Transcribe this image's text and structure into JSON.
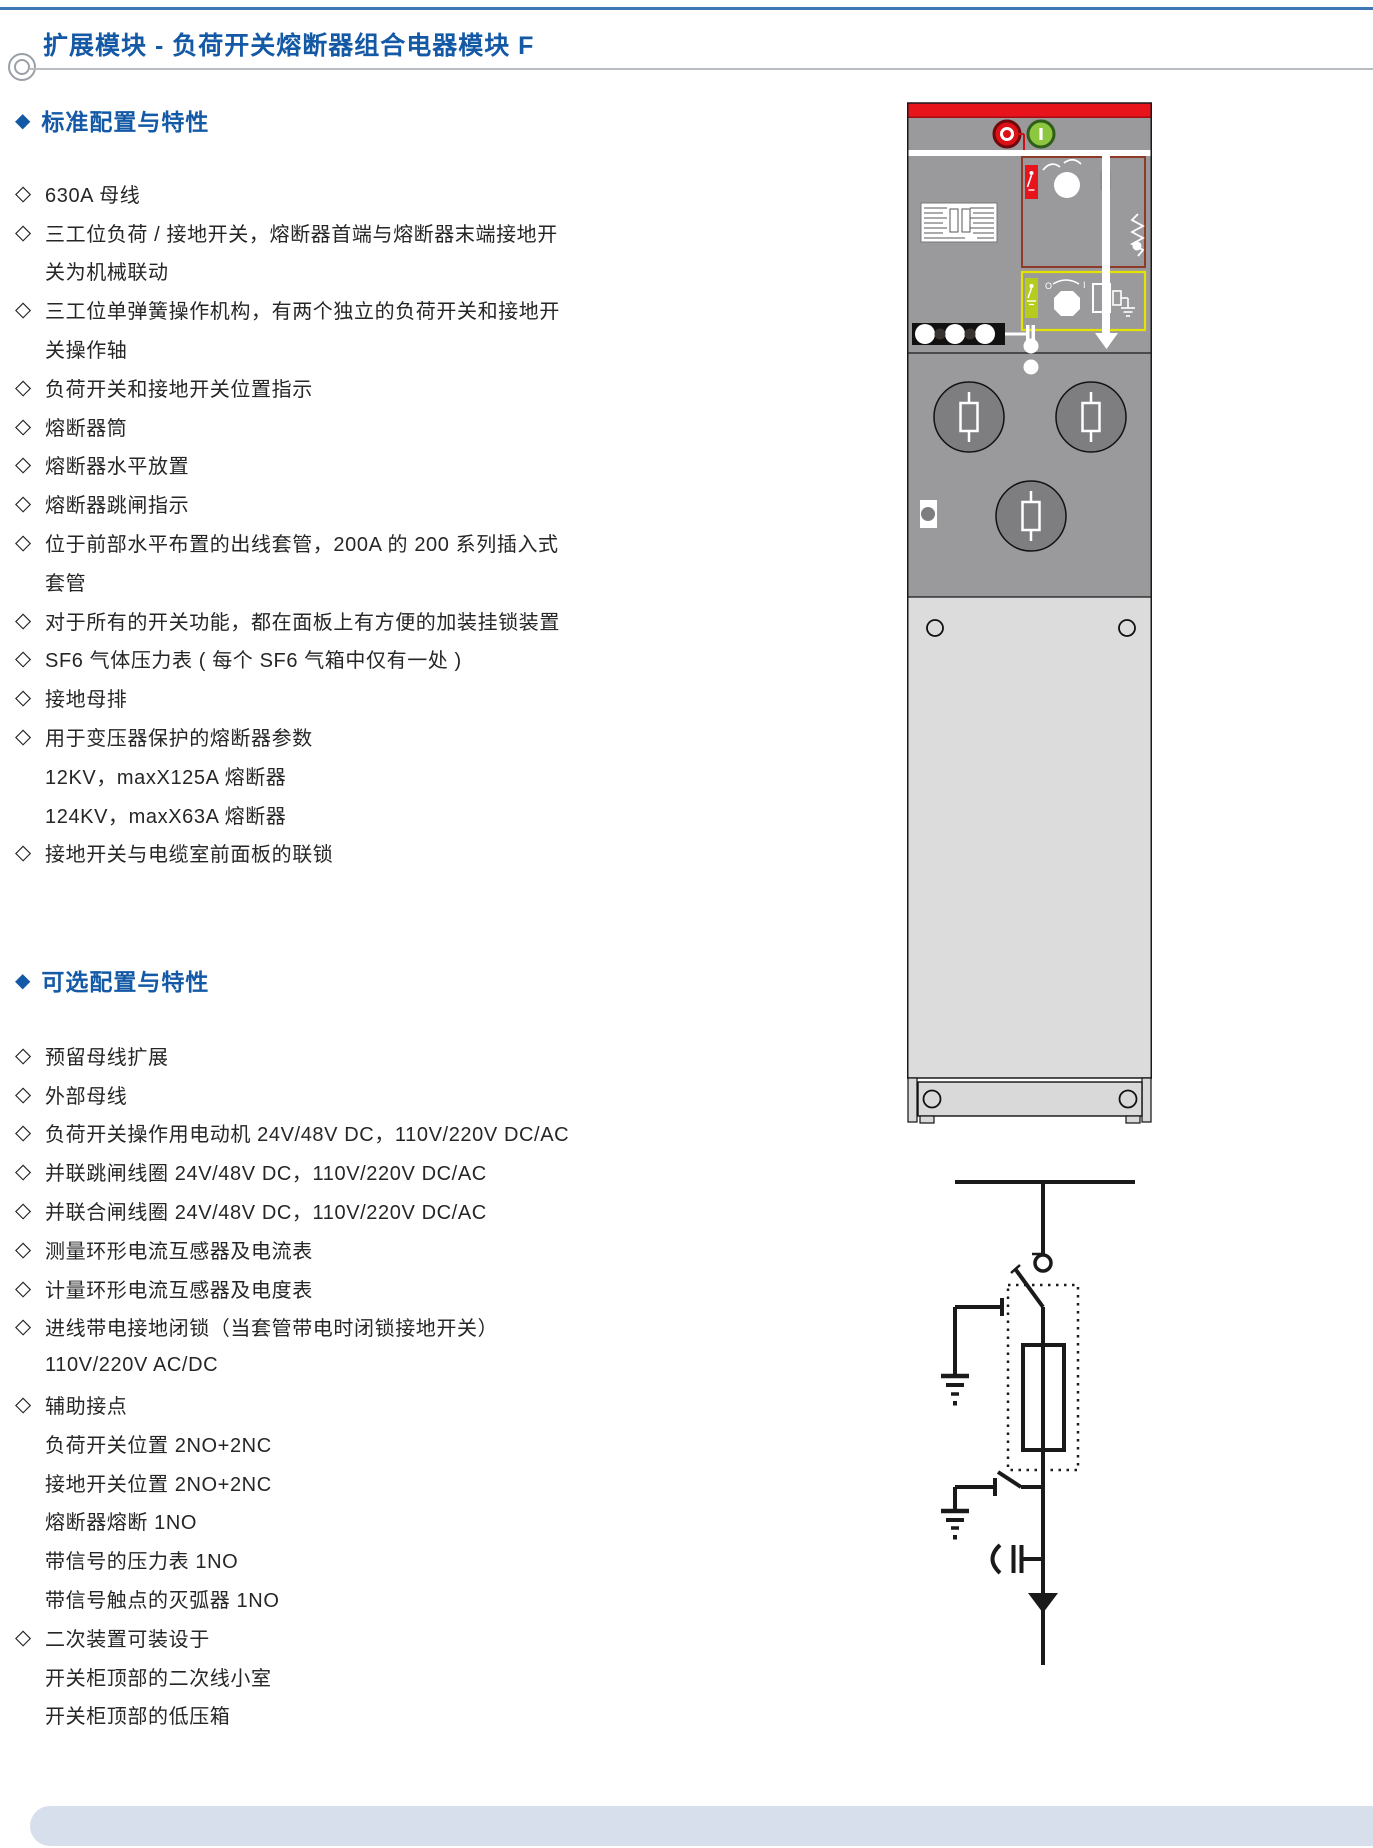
{
  "page": {
    "title": "扩展模块 - 负荷开关熔断器组合电器模块 F"
  },
  "icons": {
    "section_marker": "◆",
    "item_marker": "◇"
  },
  "colors": {
    "accent": "#1459a5",
    "text": "#262626",
    "rule": "#b9bdc1",
    "topline": "#3f77b5",
    "footer": "#d6dfeb",
    "cab_red": "#e8141c",
    "cab_red_dark": "#a50d12",
    "cab_gray": "#9a9a9c",
    "cab_gray_dark": "#7e7e81",
    "cab_light": "#dcdcdc",
    "cab_base": "#d9d9d9",
    "box_red_border": "#8f3a28",
    "box_yellow_border": "#e4e400",
    "green_button": "#8dc63f",
    "green_button_dark": "#2f5d1a",
    "lime_switch": "#b5cc1e",
    "line_black": "#1a1a1a"
  },
  "cabinet": {
    "off_button_label": "O",
    "on_button_label": "I",
    "selector_left_label": "O",
    "selector_right_label": "I"
  },
  "sections": [
    {
      "heading": "标准配置与特性",
      "lines": [
        {
          "bullet": true,
          "text": "630A 母线"
        },
        {
          "bullet": true,
          "text": "三工位负荷 / 接地开关，熔断器首端与熔断器末端接地开"
        },
        {
          "bullet": false,
          "text": "关为机械联动"
        },
        {
          "bullet": true,
          "text": "三工位单弹簧操作机构，有两个独立的负荷开关和接地开"
        },
        {
          "bullet": false,
          "text": "关操作轴"
        },
        {
          "bullet": true,
          "text": "负荷开关和接地开关位置指示"
        },
        {
          "bullet": true,
          "text": "熔断器筒"
        },
        {
          "bullet": true,
          "text": "熔断器水平放置"
        },
        {
          "bullet": true,
          "text": "熔断器跳闸指示"
        },
        {
          "bullet": true,
          "text": "位于前部水平布置的出线套管，200A 的 200 系列插入式"
        },
        {
          "bullet": false,
          "text": "套管"
        },
        {
          "bullet": true,
          "text": "对于所有的开关功能，都在面板上有方便的加装挂锁装置"
        },
        {
          "bullet": true,
          "text": "SF6 气体压力表 ( 每个 SF6 气箱中仅有一处 )"
        },
        {
          "bullet": true,
          "text": "接地母排"
        },
        {
          "bullet": true,
          "text": "用于变压器保护的熔断器参数"
        },
        {
          "bullet": false,
          "text": "12KV，maxX125A 熔断器"
        },
        {
          "bullet": false,
          "text": "124KV，maxX63A 熔断器"
        },
        {
          "bullet": true,
          "text": "接地开关与电缆室前面板的联锁"
        }
      ]
    },
    {
      "heading": "可选配置与特性",
      "lines": [
        {
          "bullet": true,
          "text": "预留母线扩展"
        },
        {
          "bullet": true,
          "text": "外部母线"
        },
        {
          "bullet": true,
          "text": "负荷开关操作用电动机 24V/48V DC，110V/220V DC/AC"
        },
        {
          "bullet": true,
          "text": "并联跳闸线圈 24V/48V DC，110V/220V DC/AC"
        },
        {
          "bullet": true,
          "text": "并联合闸线圈 24V/48V DC，110V/220V DC/AC"
        },
        {
          "bullet": true,
          "text": "测量环形电流互感器及电流表"
        },
        {
          "bullet": true,
          "text": "计量环形电流互感器及电度表"
        },
        {
          "bullet": true,
          "text": "进线带电接地闭锁（当套管带电时闭锁接地开关）"
        },
        {
          "bullet": false,
          "text": "110V/220V AC/DC"
        },
        {
          "bullet": true,
          "text": "辅助接点"
        },
        {
          "bullet": false,
          "text": "负荷开关位置 2NO+2NC"
        },
        {
          "bullet": false,
          "text": "接地开关位置 2NO+2NC"
        },
        {
          "bullet": false,
          "text": "熔断器熔断 1NO"
        },
        {
          "bullet": false,
          "text": "带信号的压力表 1NO"
        },
        {
          "bullet": false,
          "text": "带信号触点的灭弧器 1NO"
        },
        {
          "bullet": true,
          "text": "二次装置可装设于"
        },
        {
          "bullet": false,
          "text": "开关柜顶部的二次线小室"
        },
        {
          "bullet": false,
          "text": "开关柜顶部的低压箱"
        }
      ]
    }
  ]
}
